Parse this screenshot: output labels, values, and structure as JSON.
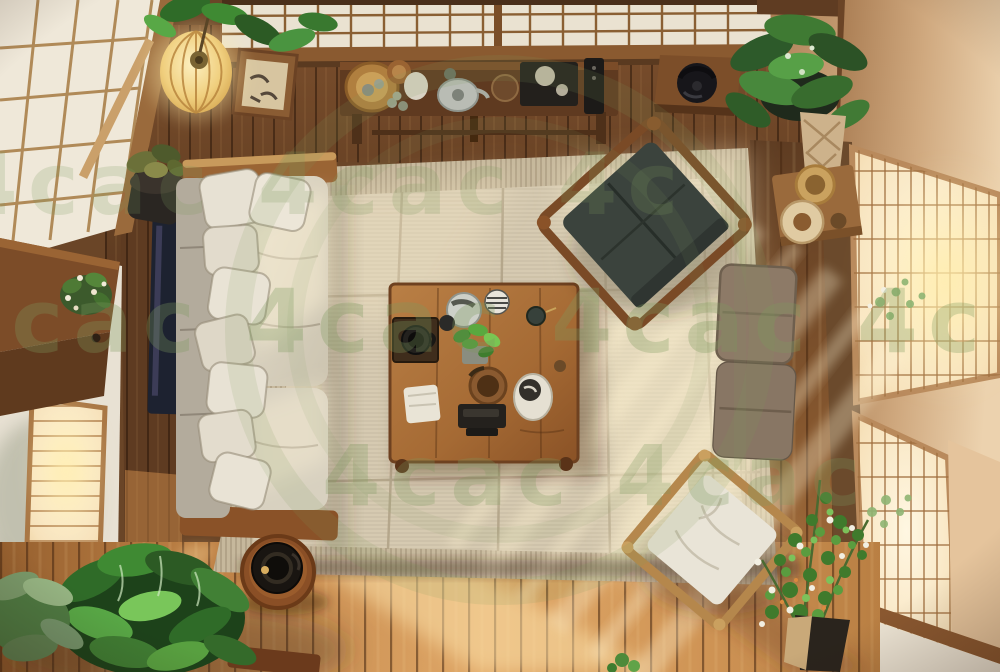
{
  "scene": {
    "description": "Top-down photographic view of a Japanese-style living room: tatami area rug, cream sofa with many pillows, low wooden tea table with tea set, dark floor chair, stacked floor cushions, wooden-frame floor chair, shoji screens, glowing lattice windows, paper lantern and many houseplants in warm sunlight.",
    "objects": [
      "shoji ceiling screens",
      "paper lantern",
      "framed artwork",
      "bonsai on stand",
      "console table with tea set",
      "corner shelf with iron kettle",
      "hanging plant",
      "wall shelf with woven plates",
      "cream fabric sofa with pillows",
      "dark media panel",
      "wooden sideboard with flowers",
      "tatami area rug",
      "low wooden tea table",
      "teapots and cups",
      "small potted plant",
      "dark floor chair",
      "stacked taupe floor cushions",
      "wooden floor chair with white cushion",
      "round wooden stool with black grinder",
      "large green houseplants",
      "flowering plant in pot",
      "sunlit lattice windows",
      "wood plank floor"
    ]
  },
  "watermark": {
    "text": "4cac",
    "row_top": "4cac 4cac 4c",
    "row_middle": "4cac 4cac 4cac 4c",
    "row_bottom": "4cac 4cac",
    "color": "#7d9a5e"
  },
  "palette": {
    "wood_dark": "#6a4527",
    "wood_mid": "#8a5a30",
    "shoji_paper": "#ece3d0",
    "shoji_frame": "#9a6a3c",
    "wall_white": "#e8e1d3",
    "wall_tan": "#c8a17b",
    "window_glow": "#f9e7c6",
    "rug_field": "#d6cab1",
    "rug_border": "#c6b89c",
    "sofa_fabric": "#d8d1c0",
    "sofa_back": "#b3ab9c",
    "pillow": "#e7e1d3",
    "table_wood": "#ab7038",
    "zaisu_seat": "#3b433d",
    "cushion_taupe": "#8d7a67",
    "chair_cushion_white": "#e9e4d7",
    "chair_frame": "#b5874c",
    "plant_mid": "#3f7d33",
    "lantern": "#f2d88e",
    "floor_lit": "#d89a5e"
  }
}
